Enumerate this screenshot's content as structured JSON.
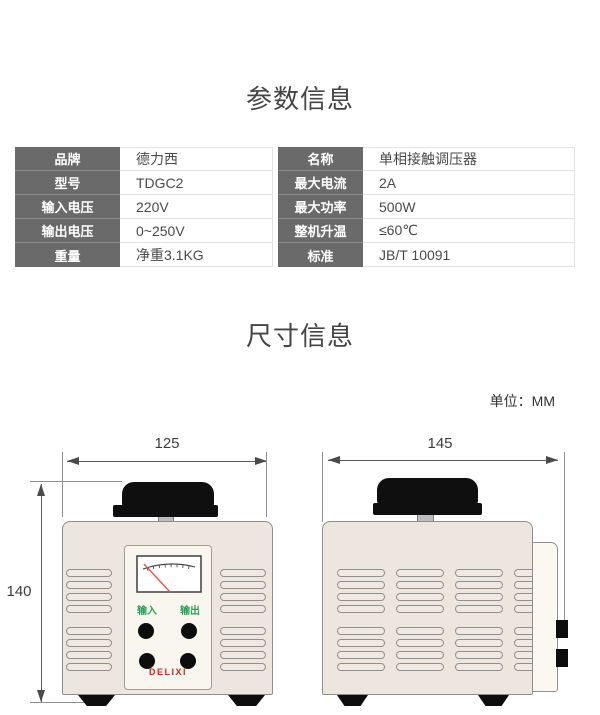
{
  "sections": {
    "params": {
      "title": "参数信息"
    },
    "dimensions": {
      "title": "尺寸信息",
      "unit_label": "单位：MM"
    }
  },
  "spec_table": {
    "left_rows": [
      {
        "label": "品牌",
        "value": "德力西"
      },
      {
        "label": "型号",
        "value": "TDGC2"
      },
      {
        "label": "输入电压",
        "value": "220V"
      },
      {
        "label": "输出电压",
        "value": "0~250V"
      },
      {
        "label": "重量",
        "value": "净重3.1KG"
      }
    ],
    "right_rows": [
      {
        "label": "名称",
        "value": "单相接触调压器"
      },
      {
        "label": "最大电流",
        "value": "2A"
      },
      {
        "label": "最大功率",
        "value": "500W"
      },
      {
        "label": "整机升温",
        "value": "≤60℃"
      },
      {
        "label": "标准",
        "value": "JB/T 10091"
      }
    ]
  },
  "drawings": {
    "front": {
      "width_dim": "125",
      "height_dim": "140",
      "input_label": "输入",
      "output_label": "输出",
      "brand_logo": "DELIXI"
    },
    "side": {
      "depth_dim": "145"
    }
  },
  "colors": {
    "table_label_bg": "#6a6a6a",
    "table_border": "#e2e2e2",
    "device_body": "#ece6df",
    "brand_red": "#d3281e",
    "terminal_green": "#2aa057",
    "needle_red": "#e05a4e"
  }
}
